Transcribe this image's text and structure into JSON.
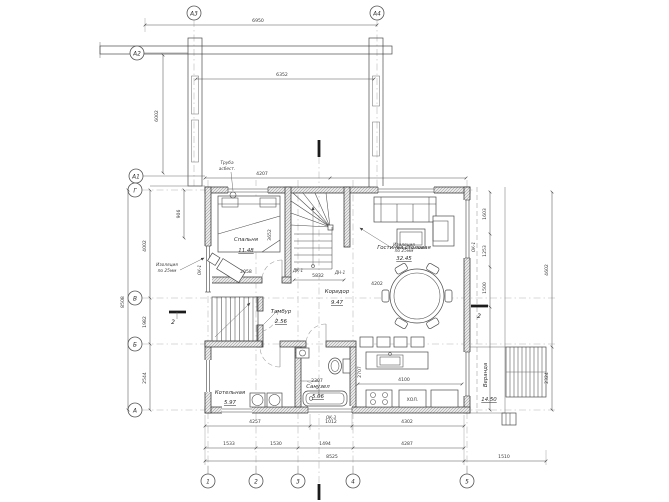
{
  "drawing": {
    "axes_top": [
      "А3",
      "А4"
    ],
    "axes_left": [
      "А2",
      "А1",
      "Г",
      "В",
      "Б",
      "А"
    ],
    "axes_bottom": [
      "1",
      "2",
      "3",
      "4",
      "5"
    ],
    "rooms": [
      {
        "name": "Спальня",
        "area": "11.48"
      },
      {
        "name": "Гостиная столовая",
        "area": "32.45"
      },
      {
        "name": "Коридор",
        "area": "9.47"
      },
      {
        "name": "Тамбур",
        "area": "2.56"
      },
      {
        "name": "Котельная",
        "area": "5.97"
      },
      {
        "name": "Санузел",
        "area": "5.06"
      },
      {
        "name": "Веранда",
        "area": "14.50"
      }
    ],
    "notes": {
      "chimney_l1": "Труба",
      "chimney_l2": "асбест.",
      "insul_left_l1": "Изоляция",
      "insul_left_l2": "по 25мм",
      "insul_right_l1": "Изоляция",
      "insul_right_l2": "по 25мм",
      "fridge": "ХОЛ."
    },
    "marks": {
      "ok1_left": "ОК-1",
      "ok1_right": "ОК-1",
      "ok3": "ОК-3",
      "dk1": "ДК-1",
      "dn1": "ДН-1",
      "section2_left": "2",
      "section2_right": "2"
    },
    "dims": {
      "top1": "6950",
      "top2": "6352",
      "a2a1": "6002",
      "left_total": "8508",
      "left_gv": "4002",
      "left_vb": "1982",
      "left_ba": "2544",
      "left_906": "906",
      "above": "4207",
      "b1a": "4257",
      "b1b": "1012",
      "b1c": "4302",
      "b2a": "1533",
      "b2b": "1530",
      "b2c": "1494",
      "b2d": "4287",
      "b3a": "8525",
      "b3b": "1510",
      "r1a": "1603",
      "r1b": "1253",
      "r1c": "1500",
      "r2a": "4602",
      "r2b": "2324",
      "in_corridor": "5832",
      "in_bedroom_b": "2058",
      "in_bedroom_v": "3652",
      "in_dining": "4202",
      "in_bath": "2307",
      "in_kitchen": "4100",
      "in_kitchen_v": "2707"
    }
  }
}
